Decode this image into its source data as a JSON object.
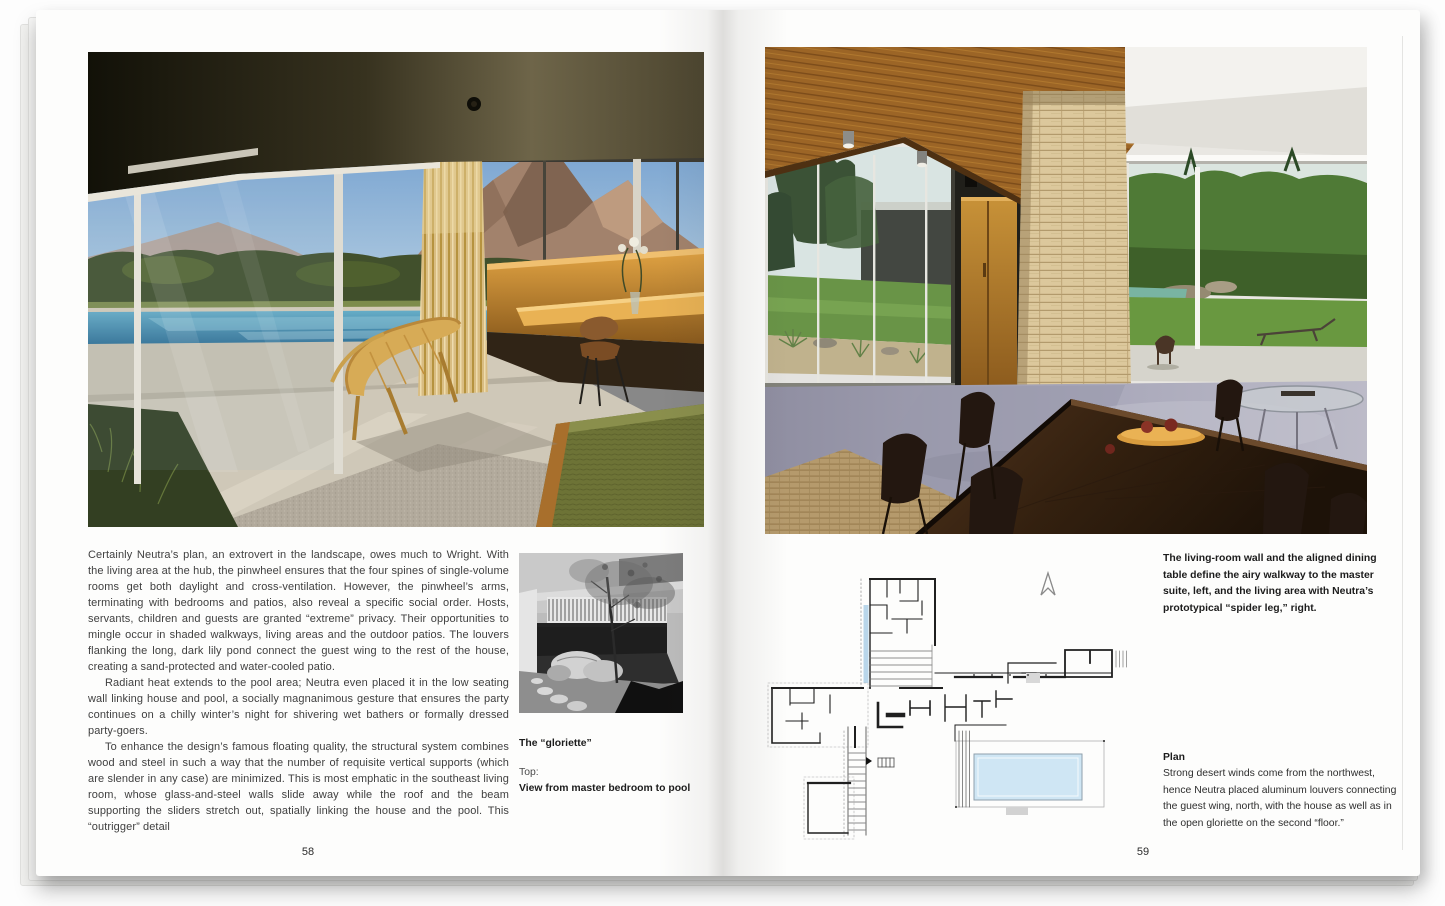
{
  "colors": {
    "paper": "#fdfdfc",
    "body_text": "#3f3f3f",
    "caption_text": "#1c1c1c",
    "page_number": "#2b2b2b",
    "pool_blue": "#3f84ab",
    "chaise_tan": "#d7ab56",
    "bed_green": "#6d7336",
    "wood_ceiling_amber": "#9c6526",
    "stone_buff": "#dcc89c",
    "floor_lavender": "#a9a8ba",
    "plan_line": "#1f1f1f",
    "plan_pool_blue": "#cfe6f4",
    "plan_pond_blue": "#b9d6ea"
  },
  "left_page": {
    "page_number": "58",
    "body_paragraphs": [
      "Certainly Neutra’s plan, an extrovert in the landscape, owes much to Wright. With the living area at the hub, the pinwheel ensures that the four spines of single-volume rooms get both daylight and cross-ventilation. However, the pinwheel’s arms, terminating with bedrooms and patios, also reveal a specific social order. Hosts, servants, children and guests are granted “extreme” privacy. Their opportunities to mingle occur in shaded walkways, living areas and the outdoor patios. The louvers flanking the long, dark lily pond connect the guest wing to the rest of the house, creating a sand-protected and water-cooled patio.",
      "Radiant heat extends to the pool area; Neutra even placed it in the low seating wall linking house and pool, a socially magnanimous gesture that ensures the party continues on a chilly winter’s night for shivering wet bathers or formally dressed party-goers.",
      "To enhance the design’s famous floating quality, the structural system combines wood and steel in such a way that the number of requisite vertical supports (which are slender in any case) are minimized. This is most emphatic in the southeast living room, whose glass-and-steel walls slide away while the roof and the beam supporting the sliders stretch out, spatially linking the house and the pool. This “outrigger” detail"
    ],
    "captions": {
      "bold_caption": "The “gloriette”",
      "position_label": "Top:",
      "position_caption": "View from master bedroom to pool"
    }
  },
  "right_page": {
    "page_number": "59",
    "photo_caption": "The living-room wall and the aligned dining table define the airy walkway to the master suite, left, and the living area with Neutra’s prototypical “spider leg,” right.",
    "plan": {
      "heading": "Plan",
      "caption": "Strong desert winds come from the northwest, hence Neutra placed aluminum louvers connecting the guest wing, north, with the house as well as in the open gloriette on the second “floor.”"
    }
  }
}
